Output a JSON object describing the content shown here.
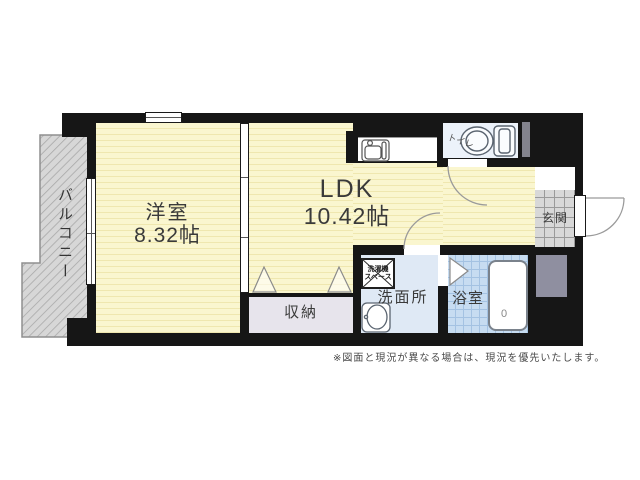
{
  "plan_title": "apartment-floor-plan",
  "rooms": {
    "balcony": {
      "label": "バルコニー"
    },
    "western_room": {
      "label": "洋室",
      "size": "8.32帖"
    },
    "ldk": {
      "label": "LDK",
      "size": "10.42帖"
    },
    "closet": {
      "label": "収納"
    },
    "washroom": {
      "label": "洗面所"
    },
    "laundry": {
      "line1": "洗濯機",
      "line2": "スペース"
    },
    "bathroom": {
      "label": "浴室",
      "tub_mark": "0"
    },
    "toilet": {
      "label": "トイレ"
    },
    "entrance": {
      "label": "玄関"
    }
  },
  "footer": {
    "disclaimer": "※図面と現況が異なる場合は、現況を優先いたします。"
  },
  "colors": {
    "wall": "#161616",
    "floor": "#FAF6CF",
    "floorStripe": "#EFE7AF",
    "balcony": "#D7D7D7",
    "balconyLine": "#A9A9A9",
    "toiletRoom": "#ECF2FA",
    "washroom": "#DFE9F5",
    "bathTile": "#C7DCF1",
    "bathTileLine": "#A4C2E2",
    "entranceTile": "#D8D8D8",
    "entranceTileLine": "#9A9A9A",
    "closet": "#E7E4EC",
    "grayBox": "#8F8FA0",
    "label": "#3A3A3A"
  }
}
